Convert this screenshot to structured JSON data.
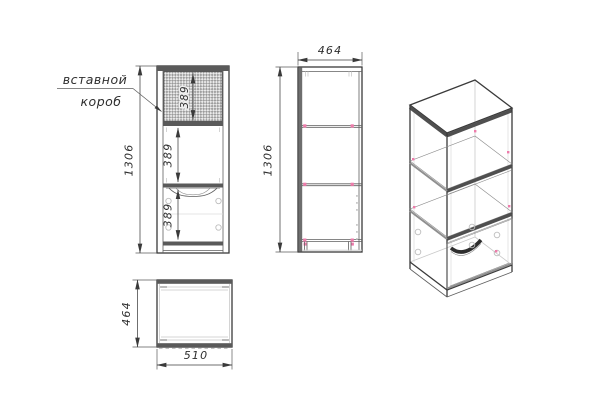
{
  "drawing": {
    "label": {
      "line1": "вставной",
      "line2": "короб"
    },
    "front_view": {
      "height": "1306",
      "top_section": "389",
      "middle_section": "389",
      "drawer_section": "389"
    },
    "side_view": {
      "width": "464",
      "height": "1306"
    },
    "top_view": {
      "depth": "464",
      "width": "510"
    },
    "colors": {
      "line": "#3a3a3a",
      "panel_band": "#5a5a5a",
      "hidden_line": "#c9c9c9",
      "fastener_pink": "#ee7cab",
      "hatch_gray": "#9b9b9b"
    }
  }
}
